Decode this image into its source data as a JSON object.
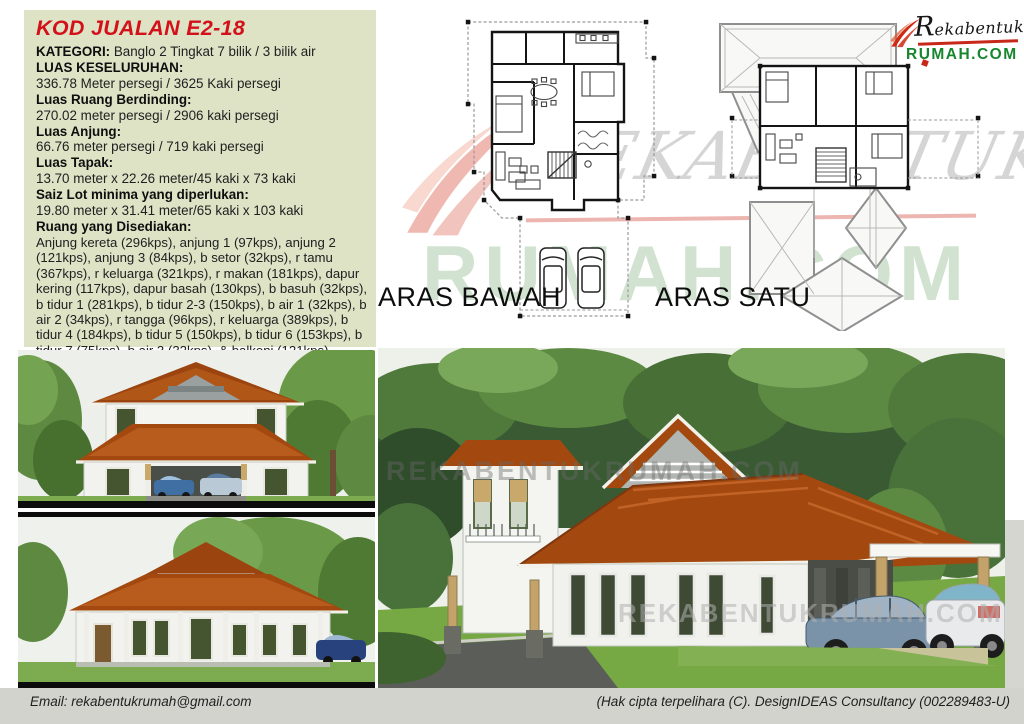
{
  "info_panel": {
    "title": "KOD JUALAN E2-18",
    "rows": [
      {
        "label": "KATEGORI:",
        "value": " Banglo 2 Tingkat 7 bilik / 3 bilik air"
      },
      {
        "label": "LUAS KESELURUHAN:",
        "value": "336.78 Meter persegi / 3625 Kaki persegi"
      },
      {
        "label": "Luas Ruang Berdinding:",
        "value": "270.02 meter persegi / 2906 kaki persegi"
      },
      {
        "label": "Luas Anjung:",
        "value": "66.76 meter persegi / 719 kaki persegi"
      },
      {
        "label": "Luas Tapak:",
        "value": "13.70 meter x 22.26 meter/45 kaki x 73 kaki"
      },
      {
        "label": "Saiz Lot minima yang diperlukan:",
        "value": "19.80 meter x 31.41 meter/65 kaki x 103 kaki"
      },
      {
        "label": "Ruang yang Disediakan:",
        "value": "Anjung kereta (296kps), anjung 1 (97kps), anjung 2 (121kps), anjung 3 (84kps), b setor (32kps), r tamu (367kps), r keluarga (321kps), r makan (181kps), dapur kering (117kps), dapur basah (130kps), b basuh (32kps), b tidur 1 (281kps), b tidur 2-3 (150kps), b air 1 (32kps), b air 2 (34kps), r tangga (96kps), r keluarga (389kps), b tidur 4 (184kps), b tidur 5 (150kps), b tidur 6 (153kps), b tidur 7 (75kps), b air 3 (32kps), & balkoni (121kps)"
      }
    ]
  },
  "plans": {
    "ground_label": "ARAS BAWAH",
    "first_label": "ARAS SATU"
  },
  "logo": {
    "initial": "R",
    "rest": "ekabentuk",
    "domain": "RUMAH.COM"
  },
  "watermarks": {
    "brand": "REKABENTUK",
    "domain": "RUMAH.COM",
    "render_text": "REKABENTUKRUMAH.COM"
  },
  "footer": {
    "email": "Email: rekabentukrumah@gmail.com",
    "copyright": "(Hak cipta terpelihara (C). DesignIDEAS Consultancy (002289483-U)"
  },
  "colors": {
    "panel_bg": "#dee3c6",
    "title_red": "#d2111a",
    "logo_green": "#17862f",
    "logo_red": "#c8281a",
    "roof_terracotta": "#a3490f",
    "footer_bg": "#d3d3ce"
  }
}
